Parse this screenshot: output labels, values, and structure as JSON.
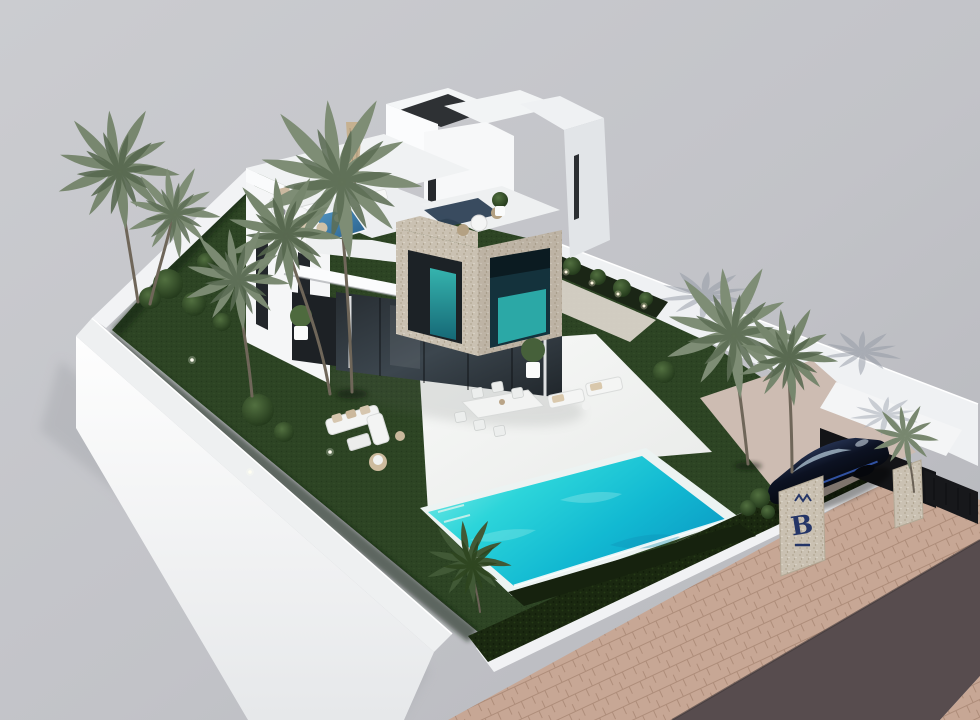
{
  "scene": {
    "kind": "3d-architectural-render",
    "subject": "modern two-storey villa with rooftop terraces, garden, swimming pool, carport and street corner, aerial axonometric view"
  },
  "sign": {
    "logo_letter": "B"
  },
  "palette": {
    "background": "#c6c7cb",
    "villa_white": "#f2f4f6",
    "stone_cladding": "#c9c0b1",
    "lawn": "#2c4323",
    "hedge": "#16220e",
    "pool_water": "#2cd5da",
    "plunge_pool": "#3b7fae",
    "road": "#574c4e",
    "sidewalk": "#c7a795",
    "car": "#0c111f",
    "car_accent": "#3f6ad0",
    "sign_letter": "#243567",
    "palm_foliage": "#7e8d75"
  },
  "objects": [
    "villa",
    "roof-access-tower",
    "rooftop-lounge-terrace",
    "parasol",
    "mid-terrace-loungers",
    "plunge-pool",
    "stone-clad-cube",
    "bistro-terrace",
    "glass-sliding-doors",
    "patio",
    "outdoor-dining-set",
    "garden-lounge-set",
    "sun-loungers",
    "swimming-pool",
    "lawn",
    "hedge",
    "palm-trees",
    "bushes",
    "garden-lights",
    "perimeter-wall",
    "planter",
    "driveway",
    "carport",
    "car",
    "entrance-pillar-sign",
    "gate-fence",
    "sidewalk",
    "road"
  ]
}
